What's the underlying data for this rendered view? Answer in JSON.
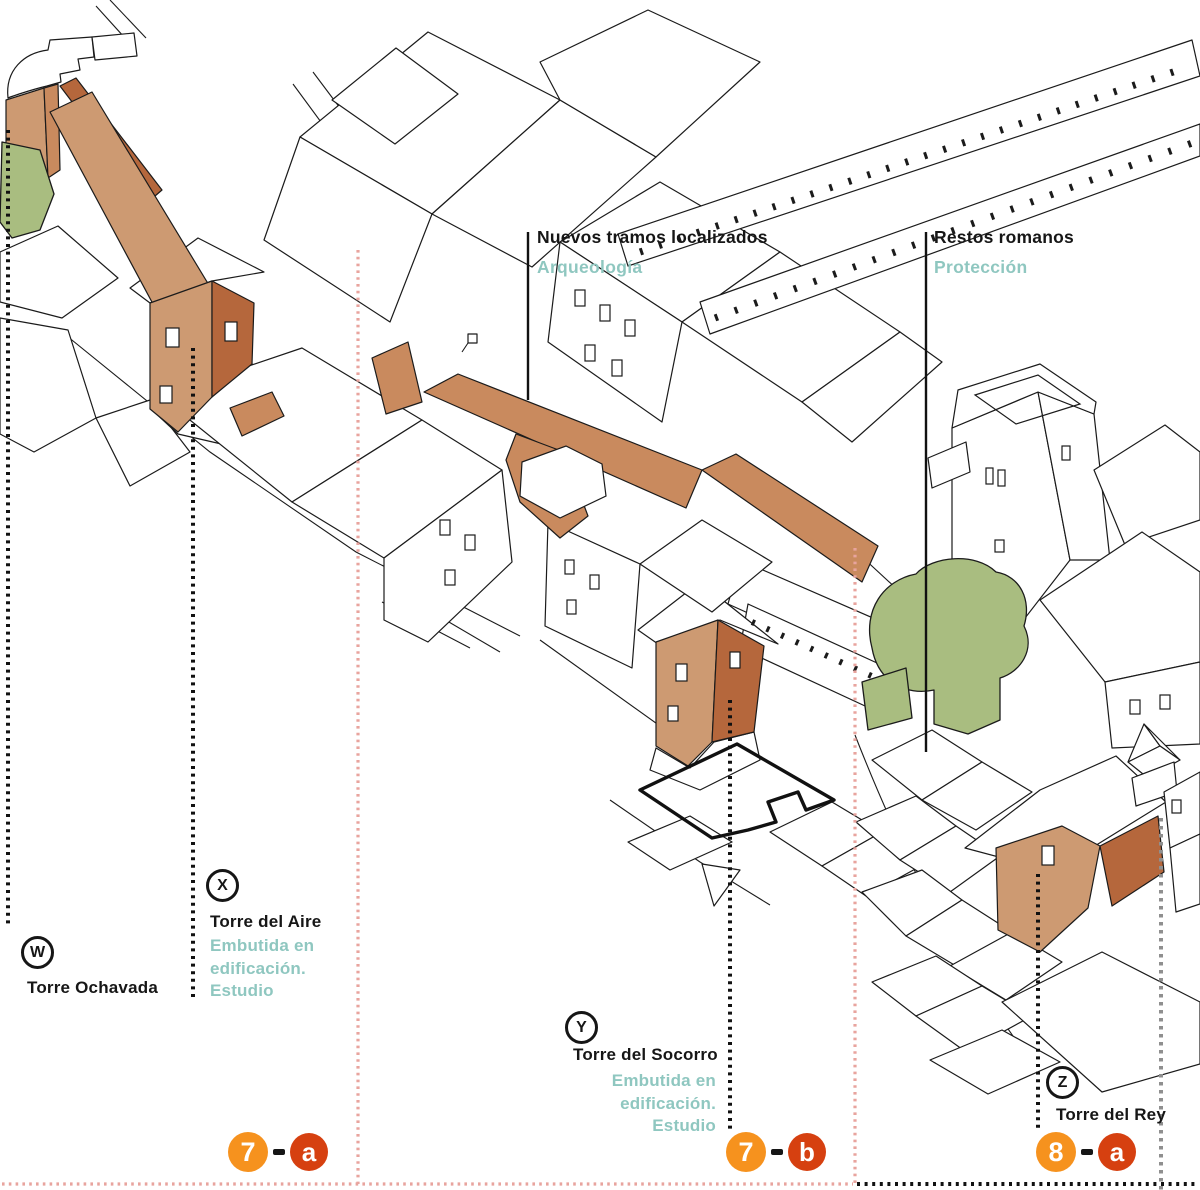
{
  "legend_new": {
    "title": "Nuevos tramos localizados",
    "subtitle": "Arqueología"
  },
  "legend_roman": {
    "title": "Restos romanos",
    "subtitle": "Protección"
  },
  "tower_w": {
    "letter": "W",
    "name": "Torre Ochavada"
  },
  "tower_x": {
    "letter": "X",
    "name": "Torre del Aire",
    "note1": "Embutida en",
    "note2": "edificación.",
    "note3": "Estudio"
  },
  "tower_y": {
    "letter": "Y",
    "name": "Torre del Socorro",
    "note1": "Embutida en",
    "note2": "edificación.",
    "note3": "Estudio"
  },
  "tower_z": {
    "letter": "Z",
    "name": "Torre del Rey"
  },
  "markers": {
    "m7a": {
      "num": "7",
      "letter": "a"
    },
    "m7b": {
      "num": "7",
      "letter": "b"
    },
    "m8a": {
      "num": "8",
      "letter": "a"
    }
  },
  "colors": {
    "ink": "#161616",
    "teal": "#8fc7c0",
    "wall_light": "#cd9a72",
    "wall_mid": "#c98a5e",
    "wall_dark": "#b5673c",
    "tree_green": "#a9bd80",
    "orange": "#f6921e",
    "red": "#d64010",
    "pink_dots": "#e8a49e",
    "gray_dots": "#8f8f8f"
  }
}
